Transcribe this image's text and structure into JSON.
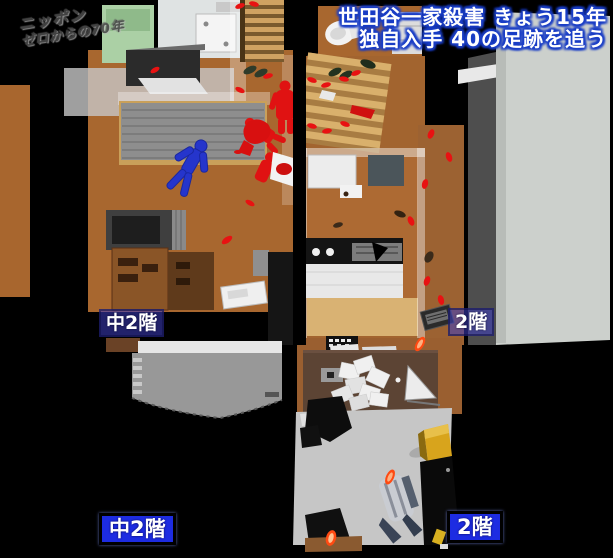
{
  "window": {
    "width": 613,
    "height": 558
  },
  "broadcast": {
    "logo_line1": "ニッポン",
    "logo_line2": "ゼロからの70年",
    "headline_line1": "世田谷一家殺害 きょう15年",
    "headline_line2": "独自入手 40の足跡を追う"
  },
  "floor_labels": {
    "upper_left": "中2階",
    "upper_right": "2階",
    "lower_left": "中2階",
    "lower_right": "2階"
  },
  "colors": {
    "background": "#000000",
    "headline_text": "#ffffff",
    "headline_outline": "#1a3ec6",
    "label_solid_blue": "#1d2ce2",
    "label_translucent_blue": "rgba(62,62,195,0.55)",
    "floor_wood_brown": "#a8672f",
    "stair_wood": "#d9b06c",
    "tatami_gray": "#8e8e8e",
    "victim_figure_blue": "#2535cc",
    "victim_figure_red": "#e01212",
    "blood_red": "#d81010",
    "footprint_red": "#e81212",
    "footprint_orange": "#ff4a12",
    "wall_panel_gray": "#ccd0cc",
    "balcony_gray": "#999999",
    "bag_yellow": "#d8a41c"
  }
}
